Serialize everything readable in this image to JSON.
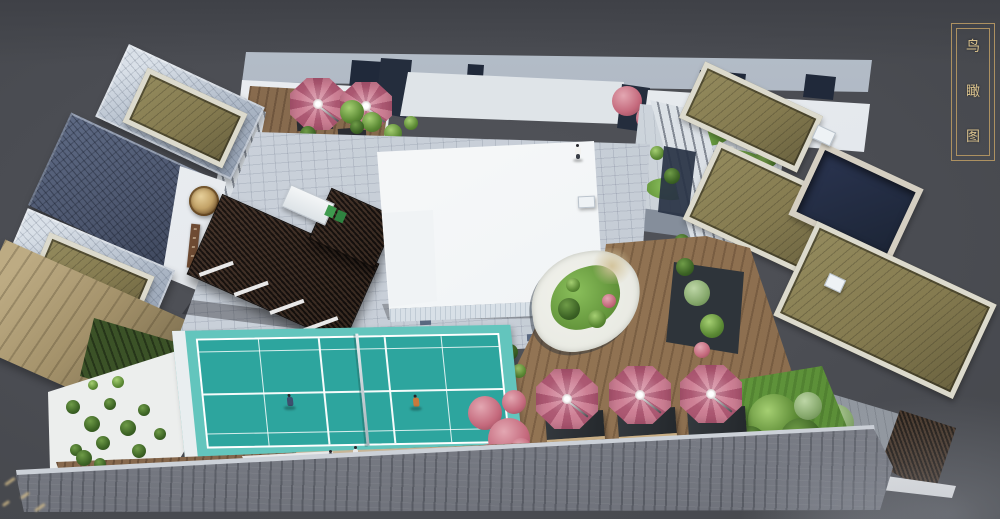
{
  "title": {
    "text": "鸟瞰图",
    "chars": [
      "鸟",
      "瞰",
      "图"
    ]
  },
  "palette": {
    "background": "#4a4c52",
    "background_deep": "#3f4147",
    "plaque_border": "#ad9161",
    "plaque_text": "#d9c18c",
    "mural_bg": "#dfe4e8",
    "paving": "#c6cdd6",
    "court_teal": "#2da59e",
    "court_light": "#63c5bd",
    "court_line": "#ffffff",
    "umbrella_pink": "#c4697c",
    "umbrella_pink_dark": "#ae5a74",
    "deck_wood": "#97795b",
    "pergola_dark": "#241b16",
    "building_white": "#f5f7f8",
    "roof_olive": "#857b50",
    "roof_bluegray": "#aab5c4",
    "roof_darktile": "#4e5870",
    "roof_tan": "#a3916a",
    "front_roof": "#8e929d",
    "lawn_green": "#6aa243",
    "gravel_white": "#e9eae3"
  },
  "scene": {
    "view": "aerial-courtyard-render",
    "parasols_large": 3,
    "parasols_patio": 2,
    "court_players": 2
  }
}
